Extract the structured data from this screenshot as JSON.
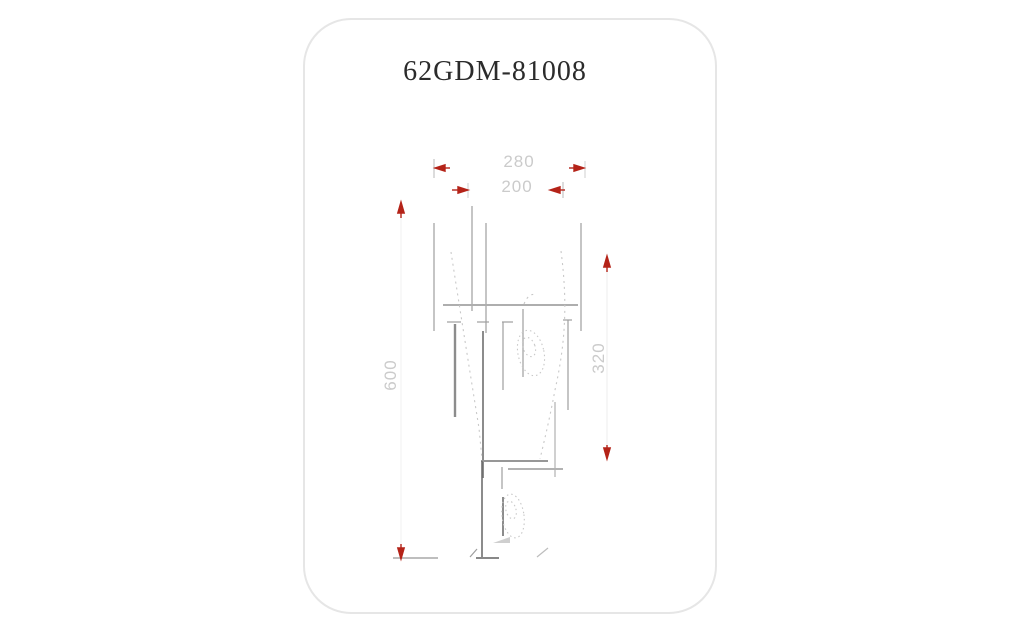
{
  "card": {
    "title": "62GDM-81008"
  },
  "drawing": {
    "dimensions": {
      "width_outer": "280",
      "width_inner": "200",
      "height_overall": "600",
      "height_body": "320"
    },
    "colors": {
      "arrow_red": "#b42318",
      "object_line_gray": "#9e9e9e",
      "dim_text_gray": "#cbcbcb",
      "card_border": "#e6e6e6"
    }
  }
}
